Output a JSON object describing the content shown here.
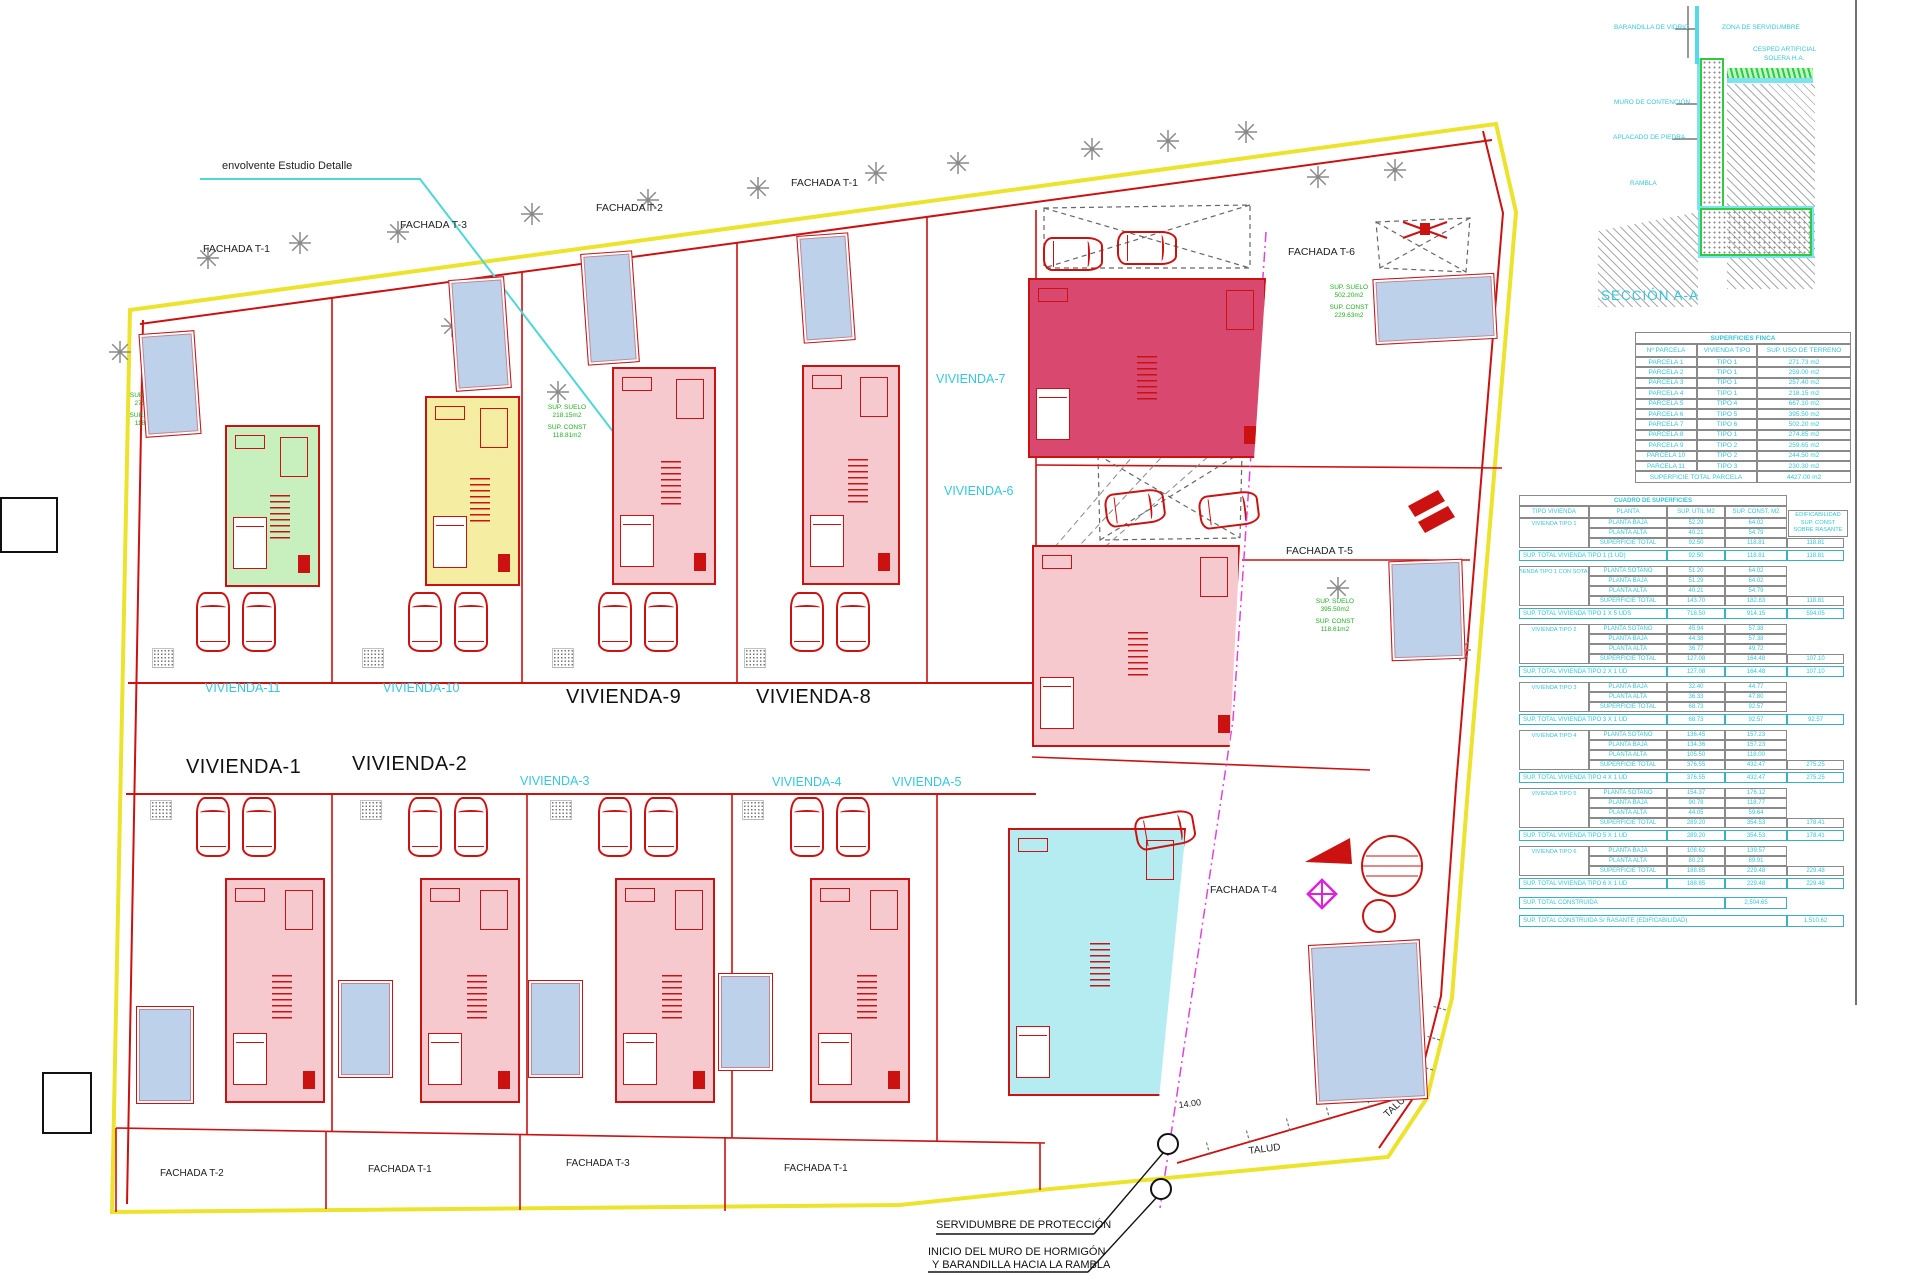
{
  "labels": {
    "envelope": "envolvente Estudio Detalle",
    "talud": "TALUD",
    "dim14": "14.00",
    "note1": "SERVIDUMBRE DE PROTECCIÓN",
    "note2a": "INICIO DEL MURO DE HORMIGÓN",
    "note2b": "Y BARANDILLA HACIA LA RAMBLA",
    "piscina": "PISCINA",
    "piscina_area_tr": "31.50 m2",
    "piscina_area_br": "36.00 m2"
  },
  "viviendas": {
    "v1": "VIVIENDA-1",
    "v2": "VIVIENDA-2",
    "v3": "VIVIENDA-3",
    "v4": "VIVIENDA-4",
    "v5": "VIVIENDA-5",
    "v6": "VIVIENDA-6",
    "v7": "VIVIENDA-7",
    "v8": "VIVIENDA-8",
    "v9": "VIVIENDA-9",
    "v10": "VIVIENDA-10",
    "v11": "VIVIENDA-11"
  },
  "fachadas": {
    "top_t1_left": "FACHADA T-1",
    "top_t3": "FACHADA T-3",
    "top_t2": "FACHADA T-2",
    "top_t1_center": "FACHADA T-1",
    "t6": "FACHADA T-6",
    "t5": "FACHADA T-5",
    "t4": "FACHADA T-4",
    "bottom_t2": "FACHADA T-2",
    "bottom_t1a": "FACHADA T-1",
    "bottom_t3": "FACHADA T-3",
    "bottom_t1b": "FACHADA T-1"
  },
  "green_notes": [
    {
      "lines": [
        "SUP. SUELO",
        "502.20m2",
        "SUP. CONST",
        "229.63m2"
      ]
    },
    {
      "lines": [
        "SUP. SUELO",
        "395.50m2",
        "SUP. CONST",
        "118.61m2"
      ]
    },
    {
      "lines": [
        "SUP. SUELO",
        "271.73m2",
        "SUP. CONST",
        "118.81m2"
      ]
    },
    {
      "lines": [
        "SUP. SUELO",
        "218.15m2",
        "SUP. CONST",
        "118.81m2"
      ]
    }
  ],
  "seccion": {
    "title": "SECCIÓN A-A",
    "labels": {
      "barandilla": "BARANDILLA DE VIDRIO",
      "zona": "ZONA DE SERVIDUMBRE",
      "cesped": "CESPED ARTIFICIAL",
      "solera": "SOLERA H.A.",
      "muro": "MURO DE CONTENCIÓN",
      "aplacado": "APLACADO DE PIEDRA",
      "rambla": "RAMBLA"
    }
  },
  "table_finca": {
    "title": "SUPERFICIES FINCA",
    "headers": [
      "Nº PARCELA",
      "VIVIENDA TIPO",
      "SUP. USO DE TERRENO"
    ],
    "rows": [
      [
        "PARCELA 1",
        "TIPO 1",
        "271.73 m2"
      ],
      [
        "PARCELA 2",
        "TIPO 1",
        "259.00 m2"
      ],
      [
        "PARCELA 3",
        "TIPO 1",
        "257.40 m2"
      ],
      [
        "PARCELA 4",
        "TIPO 1",
        "218.15 m2"
      ],
      [
        "PARCELA 5",
        "TIPO 4",
        "667.10 m2"
      ],
      [
        "PARCELA 6",
        "TIPO 5",
        "395.50 m2"
      ],
      [
        "PARCELA 7",
        "TIPO 6",
        "502.20 m2"
      ],
      [
        "PARCELA 8",
        "TIPO 1",
        "274.85 m2"
      ],
      [
        "PARCELA 9",
        "TIPO 2",
        "259.65 m2"
      ],
      [
        "PARCELA 10",
        "TIPO 2",
        "244.50 m2"
      ],
      [
        "PARCELA 11",
        "TIPO 3",
        "230.30 m2"
      ]
    ],
    "footer_label": "SUPERFICIE TOTAL PARCELA",
    "footer_value": "4427.00 m2"
  },
  "table_cuadro": {
    "title": "CUADRO DE SUPERFICIES",
    "headers": [
      "TIPO VIVIENDA",
      "PLANTA",
      "SUP. UTIL M2",
      "SUP. CONST. M2"
    ],
    "edif_note": [
      "EDIFICABILIDAD",
      "SUP. CONST",
      "SOBRE RASANTE"
    ],
    "groups": [
      {
        "name": "VIVIENDA TIPO 1",
        "rows": [
          [
            "PLANTA BAJA",
            "52.29",
            "64.02",
            ""
          ],
          [
            "PLANTA ALTA",
            "40.21",
            "54.79",
            ""
          ],
          [
            "SUPERFICIE TOTAL",
            "92.50",
            "118.81",
            "118.81"
          ]
        ],
        "total": [
          "SUP. TOTAL VIVIENDA TIPO 1 (1 UD)",
          "92.50",
          "118.81",
          "118.81"
        ]
      },
      {
        "name": "VIVIENDA TIPO 1 CON SOTANO",
        "rows": [
          [
            "PLANTA SOTANO",
            "51.20",
            "64.02",
            ""
          ],
          [
            "PLANTA BAJA",
            "51.29",
            "64.02",
            ""
          ],
          [
            "PLANTA ALTA",
            "40.21",
            "54.79",
            ""
          ],
          [
            "SUPERFICIE TOTAL",
            "143.70",
            "182.83",
            "118.81"
          ]
        ],
        "total": [
          "SUP. TOTAL VIVIENDA TIPO 1 X 5 UDS",
          "718.50",
          "914.15",
          "594.05"
        ]
      },
      {
        "name": "VIVIENDA TIPO 2",
        "rows": [
          [
            "PLANTA SOTANO",
            "45.94",
            "57.38",
            ""
          ],
          [
            "PLANTA BAJA",
            "44.38",
            "57.38",
            ""
          ],
          [
            "PLANTA ALTA",
            "36.77",
            "49.72",
            ""
          ],
          [
            "SUPERFICIE TOTAL",
            "127.08",
            "164.48",
            "107.10"
          ]
        ],
        "total": [
          "SUP. TOTAL VIVIENDA TIPO 2 X 1 UD",
          "127.08",
          "164.48",
          "107.10"
        ]
      },
      {
        "name": "VIVIENDA TIPO 3",
        "rows": [
          [
            "PLANTA BAJA",
            "32.40",
            "44.77",
            ""
          ],
          [
            "PLANTA ALTA",
            "36.33",
            "47.80",
            ""
          ],
          [
            "SUPERFICIE TOTAL",
            "68.73",
            "92.57",
            ""
          ]
        ],
        "total": [
          "SUP. TOTAL VIVIENDA TIPO 3 X 1 UD",
          "68.73",
          "92.57",
          "92.57"
        ]
      },
      {
        "name": "VIVIENDA TIPO 4",
        "rows": [
          [
            "PLANTA SOTANO",
            "136.45",
            "157.23",
            ""
          ],
          [
            "PLANTA BAJA",
            "134.36",
            "157.23",
            ""
          ],
          [
            "PLANTA ALTA",
            "105.50",
            "118.00",
            ""
          ],
          [
            "SUPERFICIE TOTAL",
            "376.55",
            "432.47",
            "275.25"
          ]
        ],
        "total": [
          "SUP. TOTAL VIVIENDA TIPO 4 X 1 UD",
          "376.55",
          "432.47",
          "275.25"
        ]
      },
      {
        "name": "VIVIENDA TIPO 5",
        "rows": [
          [
            "PLANTA SOTANO",
            "154.37",
            "176.12",
            ""
          ],
          [
            "PLANTA BAJA",
            "90.78",
            "118.77",
            ""
          ],
          [
            "PLANTA ALTA",
            "44.05",
            "59.64",
            ""
          ],
          [
            "SUPERFICIE TOTAL",
            "289.20",
            "354.53",
            "178.41"
          ]
        ],
        "total": [
          "SUP. TOTAL VIVIENDA TIPO 5 X 1 UD",
          "289.20",
          "354.53",
          "178.41"
        ]
      },
      {
        "name": "VIVIENDA TIPO 6",
        "rows": [
          [
            "PLANTA BAJA",
            "108.62",
            "139.57",
            ""
          ],
          [
            "PLANTA ALTA",
            "80.23",
            "89.91",
            ""
          ],
          [
            "SUPERFICIE TOTAL",
            "188.85",
            "229.48",
            "229.48"
          ]
        ],
        "total": [
          "SUP. TOTAL VIVIENDA TIPO 6 X 1 UD",
          "188.85",
          "229.48",
          "229.48"
        ]
      }
    ],
    "grand_totals": [
      {
        "label": "SUP. TOTAL CONSTRUIDA",
        "value": "2,504.65"
      },
      {
        "label": "SUP. TOTAL CONSTRUIDA S/ RASANTE (EDIFICABILIDAD)",
        "value": "1,510.62"
      }
    ]
  },
  "colors": {
    "boundary_yellow": "#ece32c",
    "drawing_red": "#cc1111",
    "label_cyan": "#35c8dc",
    "note_green": "#1fae1f",
    "pool_blue": "#bdd2ea",
    "house_pink": "#f6c9cf",
    "house_green": "#c8efbe",
    "house_yellow": "#f4eda2",
    "house_crimson": "#d9486e",
    "house_cyan": "#b4ecf2",
    "magenta": "#dd44dd"
  }
}
